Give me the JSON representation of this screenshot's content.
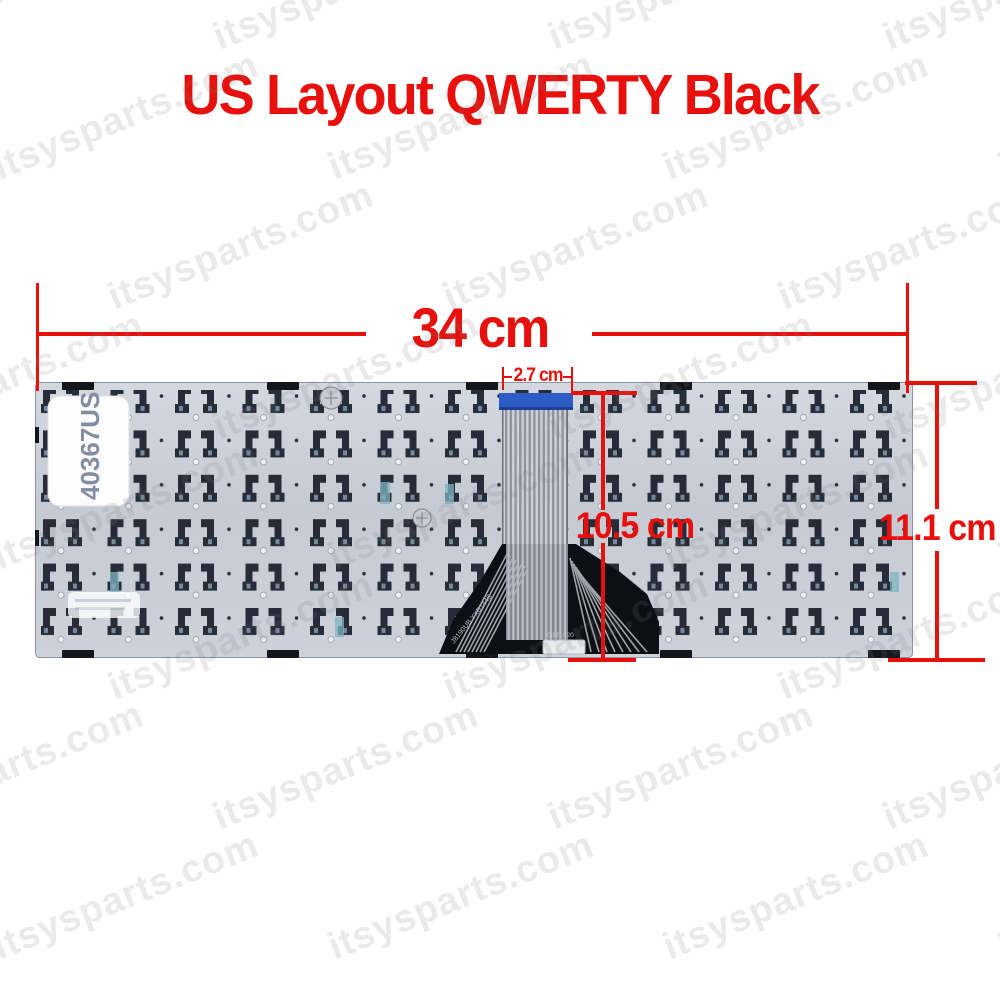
{
  "title": "US Layout QWERTY Black",
  "measurements": {
    "width_label": "34 cm",
    "cable_width_label": "2.7 cm",
    "cable_length_label": "10.5 cm",
    "height_label": "11.1 cm"
  },
  "keyboard": {
    "sticker_label": "40367US",
    "flex_print_1": "J8190UB YXB144S",
    "flex_print_2": "G181020"
  },
  "watermark": {
    "text": "itsysparts.com"
  },
  "colors": {
    "annotation_red": "#e8100d",
    "plate_gray": "#c9cdd4",
    "cable_blue": "#2e5cc5",
    "flex_black": "#0c0f15"
  }
}
